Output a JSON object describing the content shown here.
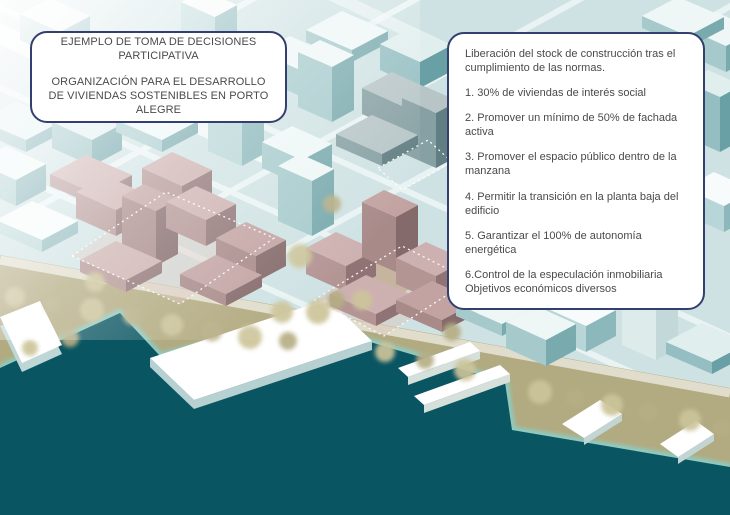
{
  "left_box": {
    "line1": "EJEMPLO DE TOMA DE DECISIONES PARTICIPATIVA",
    "line2": "ORGANIZACIÓN PARA EL DESARROLLO DE VIVIENDAS SOSTENIBLES EN PORTO ALEGRE"
  },
  "right_box": {
    "intro": "Liberación del stock de construcción tras el cumplimiento de las normas.",
    "items": [
      "1. 30% de viviendas de interés social",
      "2. Promover un mínimo de 50% de fachada activa",
      "3. Promover el espacio público dentro de la manzana",
      "4. Permitir la transición en la planta baja del edificio",
      "5. Garantizar el 100% de autonomía energética",
      "6.Control de la especulación inmobiliaria\nObjetivos económicos diversos"
    ]
  },
  "colors": {
    "box_border": "#333f6e",
    "box_text": "#4a4a4a",
    "water": "#0a5562",
    "shore_olive": "#b2aa80",
    "tree_light": "#ccc49a",
    "tree_dark": "#b6ae85",
    "city_teal_top": "#eef7f6",
    "city_teal_side": "#79aaae",
    "district_pink_top": "#cdb1b0",
    "district_pink_side": "#907475",
    "pier_white": "#ffffff",
    "district_outline": "#ffffff"
  }
}
